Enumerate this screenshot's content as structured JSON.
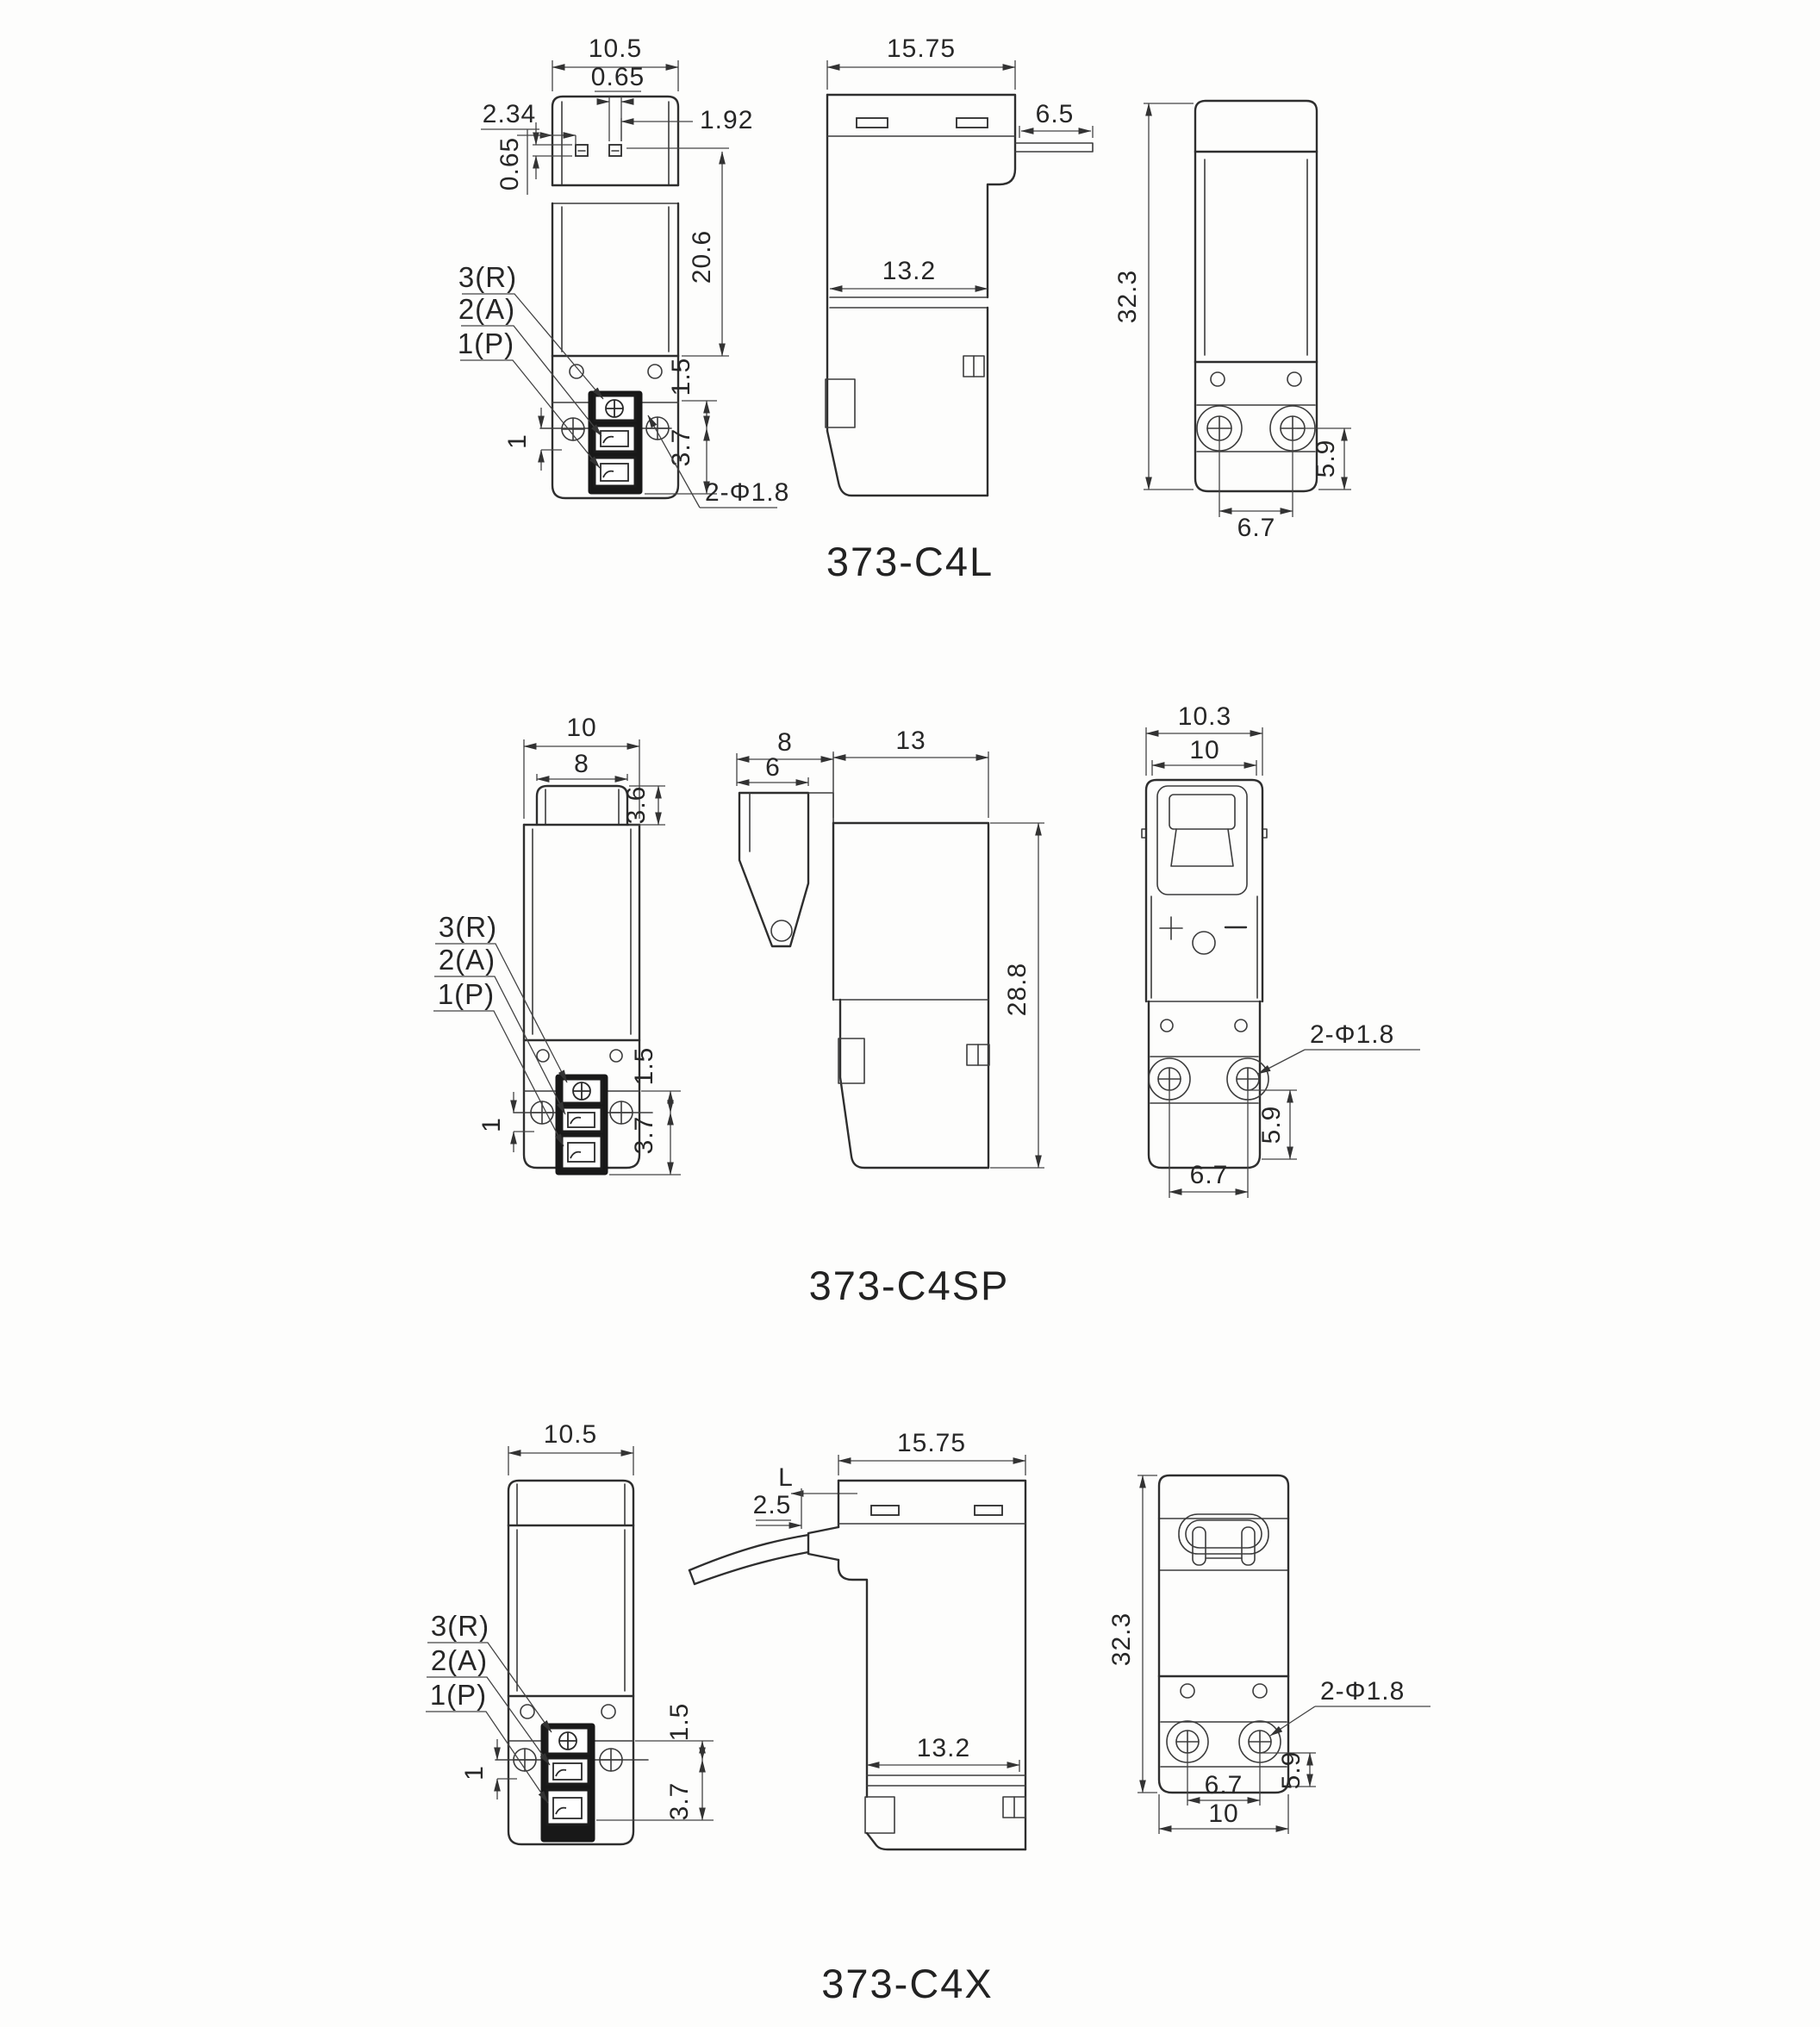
{
  "figures": [
    {
      "title": "373-C4L",
      "front": {
        "width": "10.5",
        "port_w": "0.65",
        "port_left": "2.34",
        "port_right": "1.92",
        "port_top": "0.65",
        "body_h": "20.6",
        "flange": "1.5",
        "block": "3.7",
        "ear": "1",
        "label_r": "3(R)",
        "label_a": "2(A)",
        "label_p": "1(P)",
        "holes": "2-Φ1.8"
      },
      "side": {
        "width": "15.75",
        "tab": "6.5",
        "lower_w": "13.2"
      },
      "rear": {
        "height": "32.3",
        "hole_y": "5.9",
        "hole_span": "6.7"
      }
    },
    {
      "title": "373-C4SP",
      "front": {
        "width": "10",
        "cap_w": "8",
        "cap_h": "3.6",
        "flange": "1.5",
        "block": "3.7",
        "ear": "1",
        "label_r": "3(R)",
        "label_a": "2(A)",
        "label_p": "1(P)"
      },
      "side": {
        "cap_w": "8",
        "cap_face": "6",
        "width": "13",
        "height": "28.8"
      },
      "rear": {
        "width_outer": "10.3",
        "width": "10",
        "holes": "2-Φ1.8",
        "hole_y": "5.9",
        "hole_span": "6.7"
      }
    },
    {
      "title": "373-C4X",
      "front": {
        "width": "10.5",
        "flange": "1.5",
        "block": "3.7",
        "ear": "1",
        "label_r": "3(R)",
        "label_a": "2(A)",
        "label_p": "1(P)"
      },
      "side": {
        "cable_len": "L",
        "cable_off": "2.5",
        "width": "15.75",
        "lower_w": "13.2"
      },
      "rear": {
        "height": "32.3",
        "holes": "2-Φ1.8",
        "hole_y": "5.9",
        "hole_span": "6.7",
        "width": "10"
      }
    }
  ]
}
